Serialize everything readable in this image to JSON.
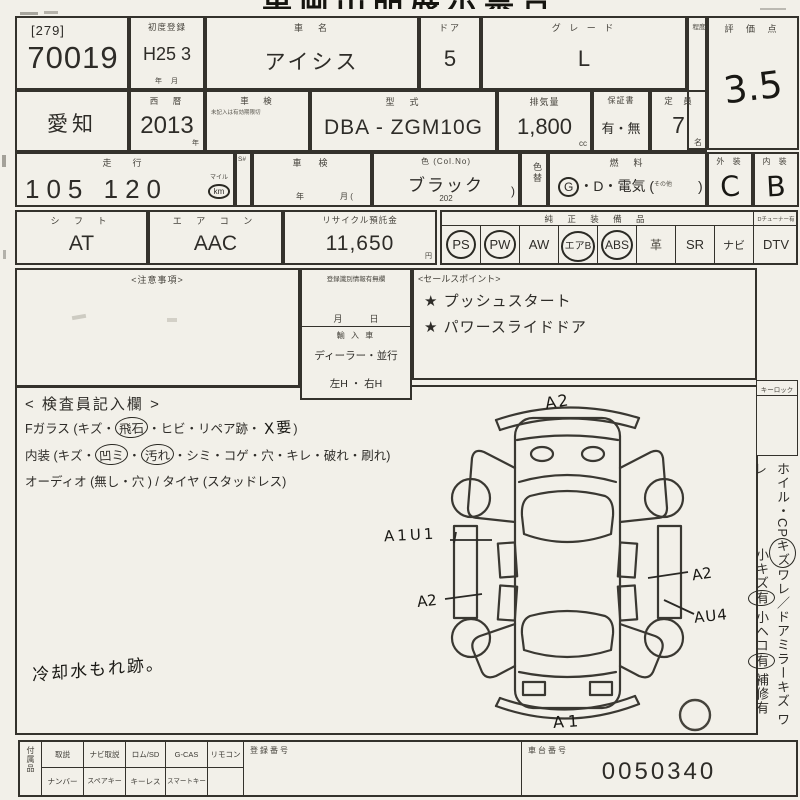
{
  "top": {
    "cut_title": "車両出品展示票合"
  },
  "row1": {
    "lot_bracket": "[279]",
    "lot_number": "70019",
    "first_reg_label": "初度登録",
    "first_reg_value": "H25 3",
    "first_reg_units": "年　月",
    "car_name_label": "車　名",
    "car_name_value": "アイシス",
    "door_label": "ドア",
    "door_value": "5",
    "grade_label": "グ レ ー ド",
    "grade_value": "L",
    "narrow_label": "程度",
    "score_label": "評 価 点",
    "score_value": "3.5"
  },
  "row2": {
    "prefecture": "愛知",
    "era_label": "西　暦",
    "era_value": "2013",
    "era_unit": "年",
    "shaken_label": "車　検",
    "shaken_sub": "未記入は有効期限切",
    "model_label": "型　式",
    "model_value": "DBA - ZGM10G",
    "disp_label": "排気量",
    "disp_value": "1,800",
    "disp_unit": "cc",
    "warranty_label": "保証書",
    "warranty_value": "有・無",
    "capacity_label": "定　員",
    "capacity_value": "7",
    "capacity_unit": "名"
  },
  "row3": {
    "mileage_label": "走　行",
    "mileage_value": "105 120",
    "mileage_unit_top": "マイル",
    "mileage_unit": "km",
    "s_label": "S#",
    "shaken2_label": "車　検",
    "shaken2_year": "年",
    "shaken2_month": "月 (",
    "color_label": "色 (Col.No)",
    "color_value": "ブラック",
    "color_code": "202",
    "color_paren": ")",
    "color_change_label": "色替",
    "fuel_label": "燃　料",
    "fuel_g": "G",
    "fuel_rest": "・D・電気 (",
    "fuel_other": "その他",
    "fuel_close": ")",
    "ext_label": "外 装",
    "ext_value": "C",
    "int_label": "内 装",
    "int_value": "B"
  },
  "row4": {
    "shift_label": "シ フ ト",
    "shift_value": "AT",
    "aircon_label": "エ ア コ ン",
    "aircon_value": "AAC",
    "recycle_label": "リサイクル預託金",
    "recycle_value": "11,650",
    "recycle_unit": "円",
    "equip_label": "純 正 装 備 品",
    "tuner_label": "Dチューナー有",
    "equipment": [
      {
        "label": "PS",
        "circled": true
      },
      {
        "label": "PW",
        "circled": true
      },
      {
        "label": "AW",
        "circled": false
      },
      {
        "label": "エアB",
        "circled": true
      },
      {
        "label": "ABS",
        "circled": true
      },
      {
        "label": "革",
        "circled": false
      },
      {
        "label": "SR",
        "circled": false
      },
      {
        "label": "ナビ",
        "circled": false
      },
      {
        "label": "DTV",
        "circled": false
      }
    ]
  },
  "notes": {
    "caution_label": "<注意事項>",
    "reg_label": "登録識別情報有無欄",
    "reg_date": "月　　　日",
    "import_label": "輸 入 車",
    "import_options": "ディーラー・並行",
    "handle_options": "左H ・ 右H",
    "sales_label": "<セールスポイント>",
    "sales_points": [
      "★ プッシュスタート",
      "★ パワースライドドア"
    ]
  },
  "inspector": {
    "header": "< 検査員記入欄 >",
    "line1": [
      {
        "t": "Fガラス (キズ・",
        "c": false
      },
      {
        "t": "飛石",
        "c": true
      },
      {
        "t": "・ヒビ・リペア跡・ ",
        "c": false
      },
      {
        "t": "X要",
        "c": false,
        "hand": true
      },
      {
        "t": ")",
        "c": false
      }
    ],
    "line2": [
      {
        "t": "内装 (キズ・",
        "c": false
      },
      {
        "t": "凹ミ",
        "c": true
      },
      {
        "t": "・",
        "c": false
      },
      {
        "t": "汚れ",
        "c": true
      },
      {
        "t": "・シミ・コゲ・穴・キレ・破れ・刷れ)",
        "c": false
      }
    ],
    "line3": [
      {
        "t": "オーディオ (無し・穴 ) / タイヤ (スタッドレス)",
        "c": false
      }
    ],
    "hand_note": "冷却水もれ跡。"
  },
  "diagram": {
    "mark_top": "A2",
    "mark_left_upper": "A1U1",
    "mark_left_lower": "A2",
    "mark_right_upper": "A2",
    "mark_right_lower": "AU4",
    "mark_bottom": "A1"
  },
  "right_panel": {
    "keylock_label": "キーロック",
    "line1": [
      {
        "t": "ホイル・CP",
        "c": false
      },
      {
        "t": "キズ",
        "c": true
      },
      {
        "t": "ワレ／ドアミラーキズ ワレ",
        "c": false
      }
    ],
    "line2": [
      {
        "t": "小キズ",
        "c": false
      },
      {
        "t": "有",
        "c": true
      },
      {
        "t": " 小ヘコ",
        "c": false
      },
      {
        "t": "有",
        "c": true
      },
      {
        "t": " 補修有",
        "c": false
      }
    ]
  },
  "bottom": {
    "accessories_label": "付属品",
    "row1": [
      "取説",
      "ナビ取説",
      "ロム/SD",
      "G-CAS",
      "リモコン"
    ],
    "row2": [
      "ナンバー",
      "スペアキー",
      "キーレス",
      "スマートキー"
    ],
    "reg_number_label": "登録番号",
    "chassis_label": "車台番号",
    "chassis_value": "0050340"
  }
}
